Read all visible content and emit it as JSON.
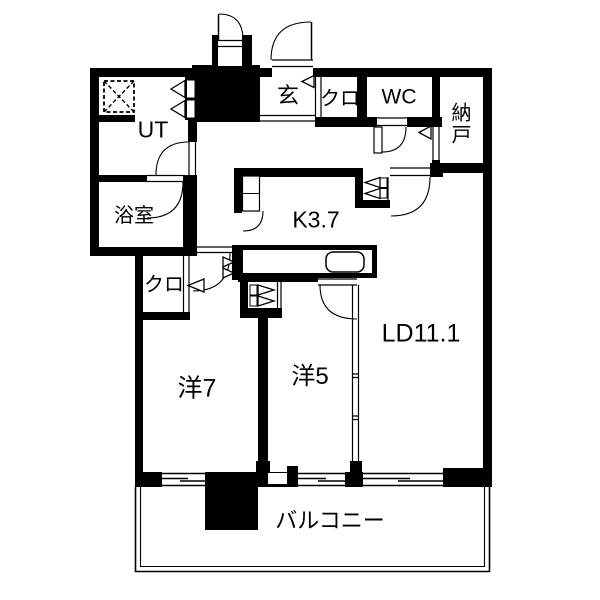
{
  "colors": {
    "wall": "#000000",
    "background": "#ffffff"
  },
  "labels": {
    "genkan": "玄",
    "closet_entry": "クロ",
    "wc": "WC",
    "nando": "納戸",
    "ut": "UT",
    "bathroom": "浴室",
    "kitchen": "K3.7",
    "closet_hall": "クロ",
    "western7": "洋7",
    "western5": "洋5",
    "living_dining": "LD11.1",
    "balcony": "バルコニー"
  }
}
